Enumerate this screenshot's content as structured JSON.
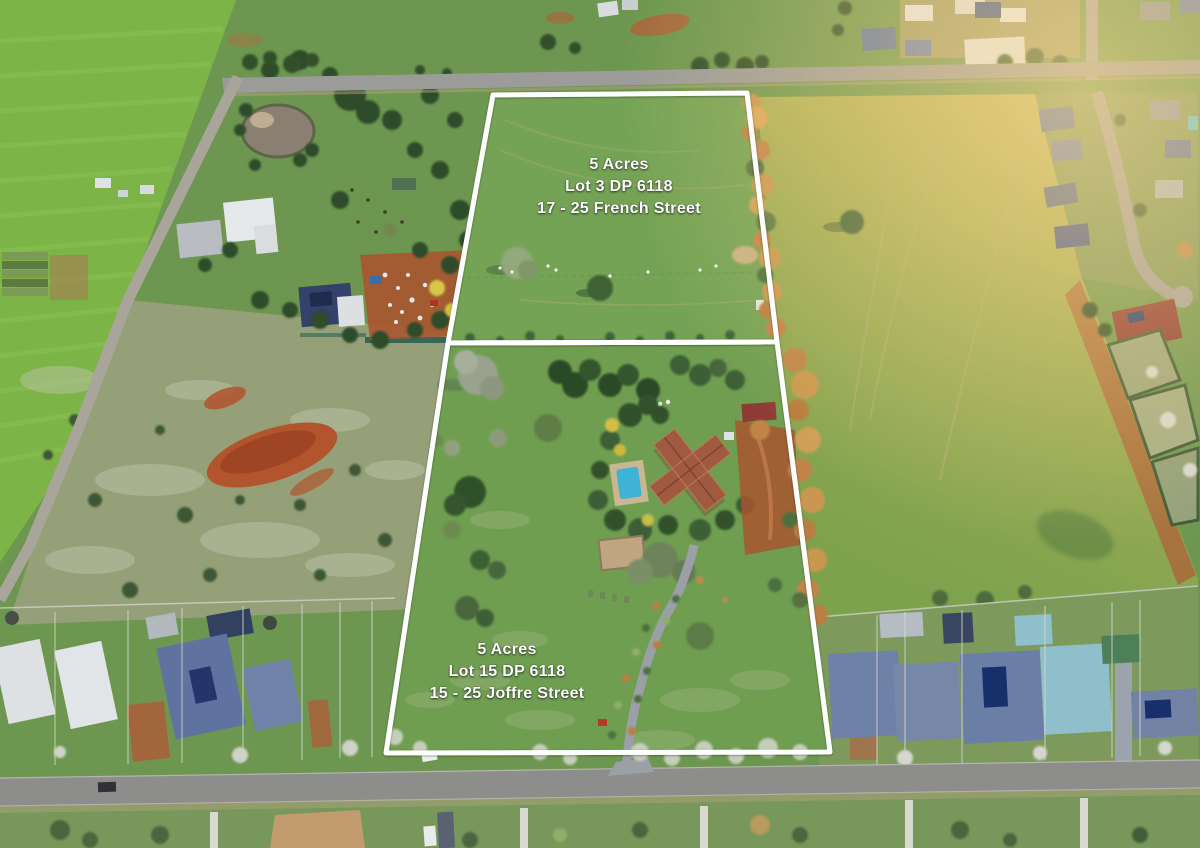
{
  "overlay": {
    "stroke_color": "#ffffff",
    "stroke_width": 5,
    "lots": [
      {
        "label_lines": [
          "5 Acres",
          "Lot 3 DP 6118",
          "17 - 25 French Street"
        ],
        "label_center": {
          "x": 619,
          "y": 187
        },
        "polygon": [
          [
            493,
            95
          ],
          [
            747,
            93
          ],
          [
            777,
            342
          ],
          [
            448,
            343
          ]
        ]
      },
      {
        "label_lines": [
          "5 Acres",
          "Lot 15 DP 6118",
          "15 - 25 Joffre Street"
        ],
        "label_center": {
          "x": 507,
          "y": 672
        },
        "polygon": [
          [
            448,
            343
          ],
          [
            777,
            342
          ],
          [
            830,
            752
          ],
          [
            386,
            753
          ]
        ]
      }
    ]
  },
  "photo": {
    "description": "aerial drone view of two 5-acre lots outlined in white between a top road and a bottom residential street",
    "palette": {
      "grass_green": "#6d9750",
      "crop_field_green": "#7cb447",
      "sunlit_field_yellow": "#c2b65e",
      "scrub_paddock": "#95a078",
      "red_dirt": "#b2542e",
      "road_gray": "#9b9b99",
      "street_gray": "#8d8d8b",
      "roof_slate_blue": "#6e81a6",
      "roof_white": "#e2e5e7",
      "roof_terracotta": "#a0543f",
      "pool_blue": "#3fb3d6",
      "autumn_tree_orange": "#c08448",
      "tree_dark_green": "#2f4d2a",
      "blossom_pale": "#cfd3c7"
    }
  }
}
